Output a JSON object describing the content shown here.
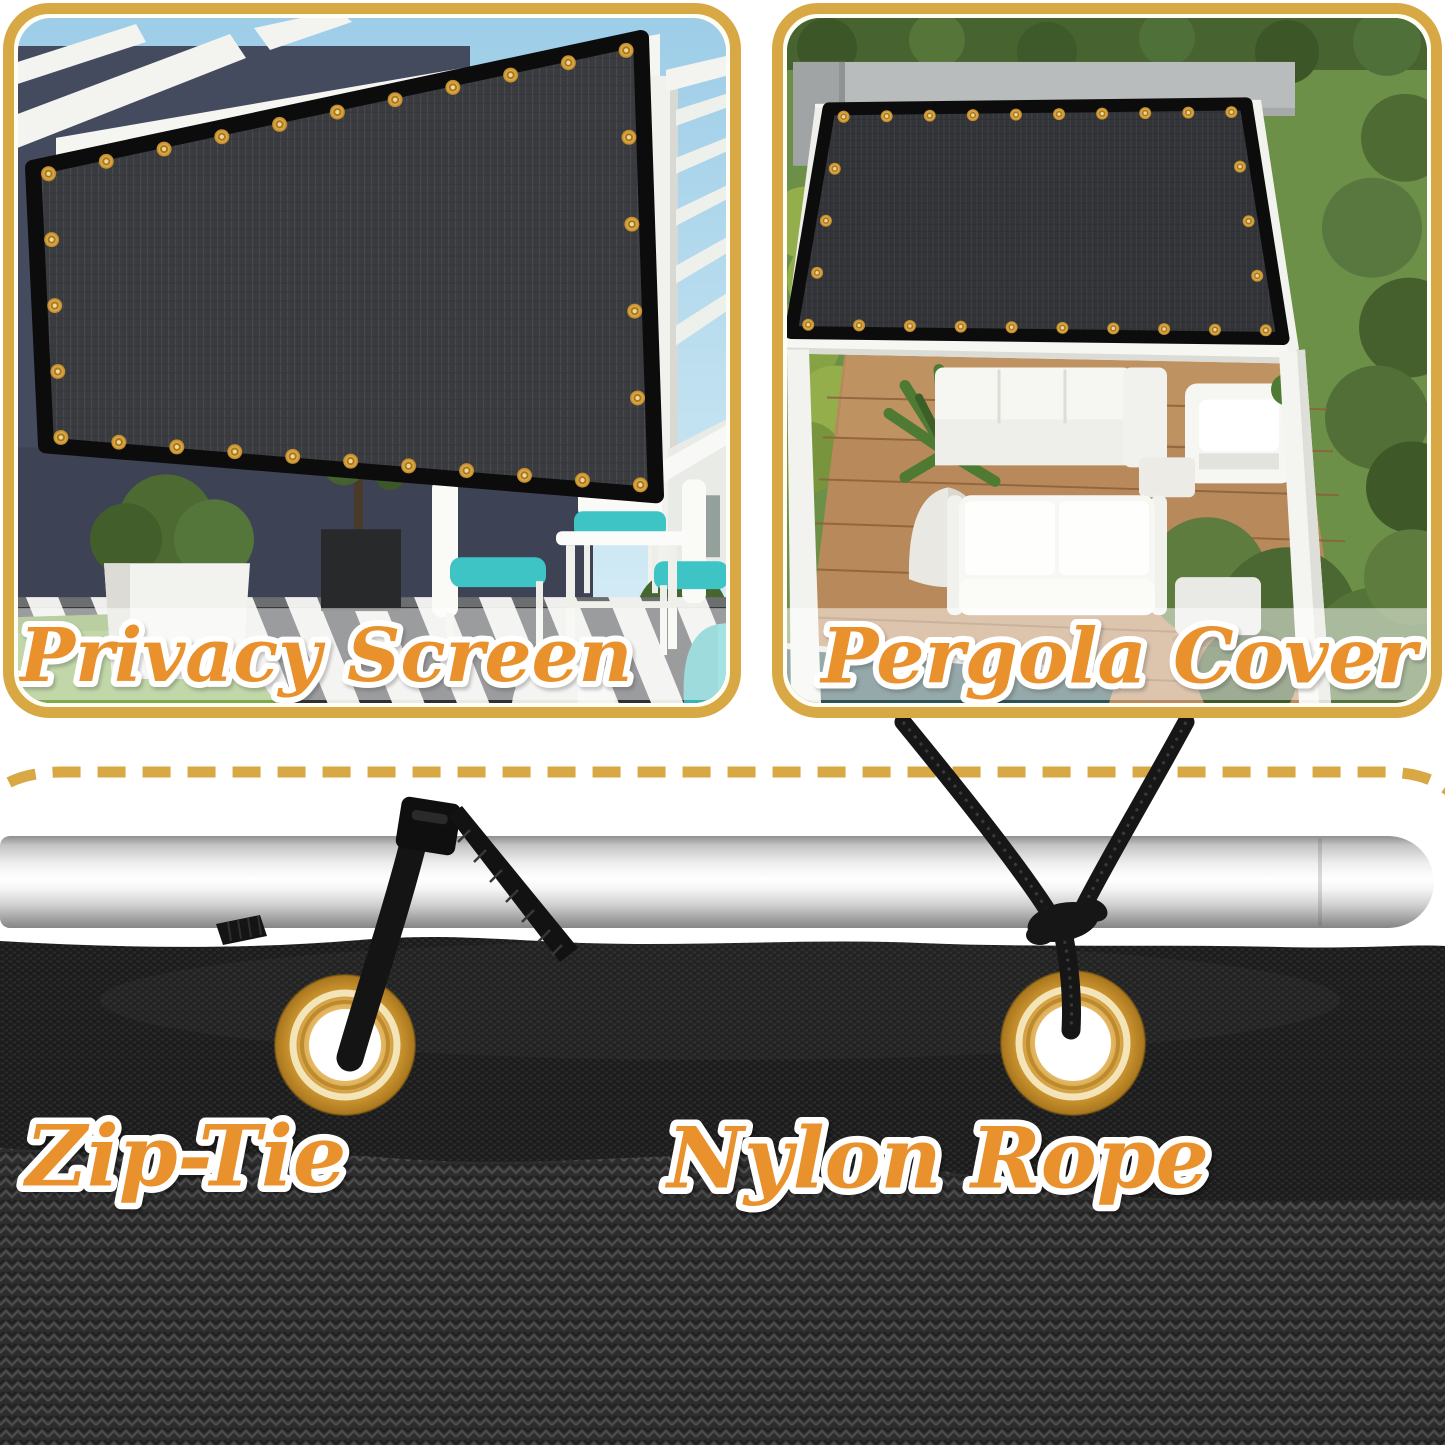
{
  "product_views": {
    "privacy_screen": {
      "label": "Privacy Screen"
    },
    "pergola_cover": {
      "label": "Pergola Cover"
    }
  },
  "attachment_methods": {
    "zip_tie": {
      "label": "Zip-Tie"
    },
    "nylon_rope": {
      "label": "Nylon Rope"
    }
  },
  "theme": {
    "accent_gold": "#D8A845",
    "label_orange": "#E8912D",
    "label_outline": "#FFFFFF",
    "fabric_black": "#1C1C1C",
    "grommet_gold": "#E7B65A",
    "pole_silver": "#E8E8E8"
  }
}
